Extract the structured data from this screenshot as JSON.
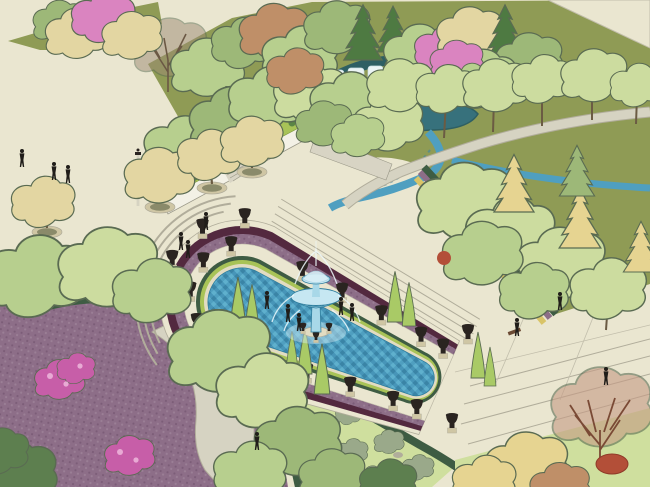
{
  "scene": {
    "kind": "3d-landscape-garden-render",
    "visible_text": ""
  },
  "palette": {
    "cream": "#eae6d0",
    "stone": "#d6d3c2",
    "stone_dark": "#b1ad9b",
    "stone_line": "#c2beab",
    "olive": "#8f9b55",
    "lawn_light": "#cfdf9e",
    "hedge_dark": "#3e5c43",
    "hedge_bright": "#a8c357",
    "purple_bed": "#8d6e88",
    "purple_dark": "#7c5d78",
    "purple_light": "#9b7f96",
    "maroon": "#53293f",
    "yellow_border": "#d9c467",
    "water": "#4f9fc0",
    "water_dark": "#3a84a6",
    "water_mid": "#4795b8",
    "water_light": "#5fb0cd",
    "pond": "#37717c",
    "pond_dark": "#2e5f63",
    "waterfall": "#ebf4f4",
    "waterfall_streak": "#bcd9df",
    "wall": "#f3f1e6",
    "wall_shadow": "#d8d4c4",
    "wall_line": "#9a9888",
    "coping": "#e2dcc2",
    "urn": "#2a2420",
    "pedestal": "#cfc6a4",
    "planter_soil": "#8a8a6a",
    "trunk": "#7c6a4e",
    "trunk_dark": "#6b5b43",
    "figure": "#201d19",
    "fountain_glass": "#a8d8e8",
    "fountain_glass_light": "#c6e7f2",
    "fountain_rim": "#2f7e9e",
    "jet": "#eef9fc",
    "tree_outline": "#5a6b52",
    "tree_light": "#b7cf8e",
    "tree_pale": "#ccdc9f",
    "tree_mid": "#9db878",
    "tree_dark": "#5d7f4f",
    "tree_deep": "#4e7a42",
    "tree_yellow": "#e6d491",
    "tree_ypale": "#e3d6a2",
    "tree_autumn": "#bf8f68",
    "pink": "#da84c0",
    "pink_light": "#e8aad4",
    "pink_deep": "#c75ea8",
    "red_bush": "#b34f38",
    "bare_branch": "#6b5844",
    "twig": "#9b8a74",
    "twig_red": "#c59a84",
    "cone_green": "#a9ca66",
    "sage_shrub": "#9aa98a",
    "bench": "#6b4a33"
  }
}
